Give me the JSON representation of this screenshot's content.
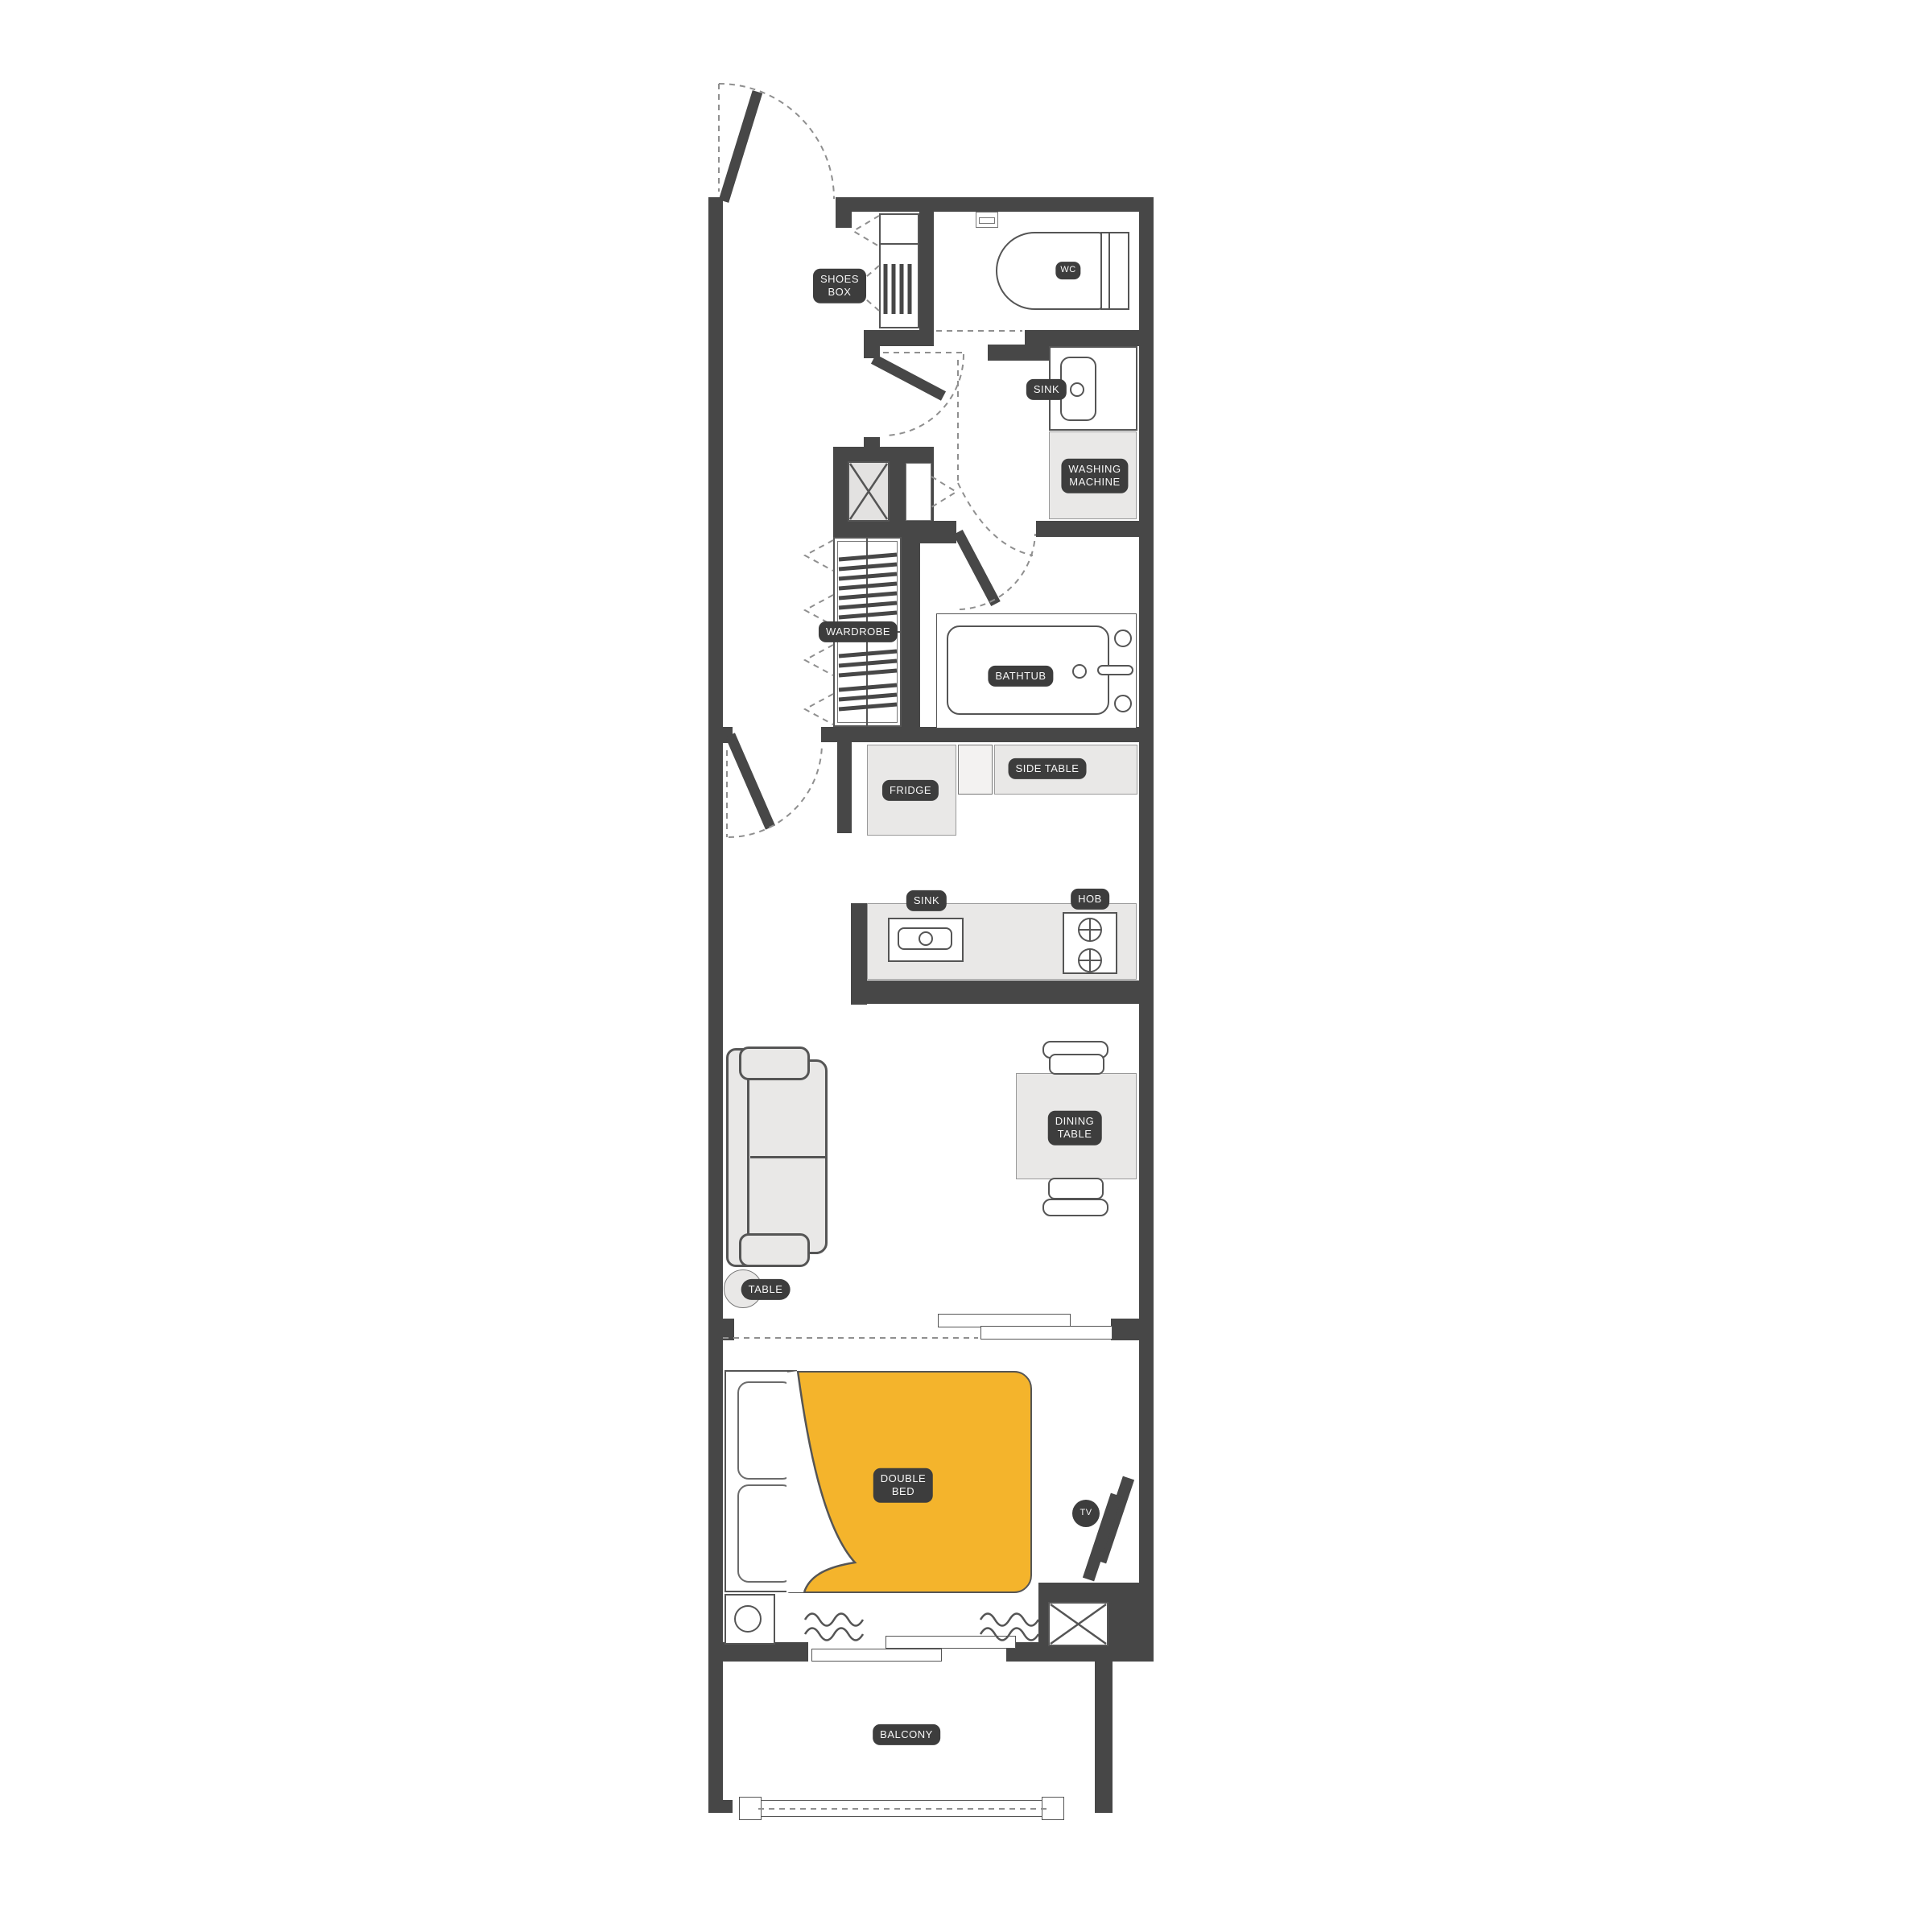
{
  "colors": {
    "wall": "#474747",
    "furniture": "#e9e8e7",
    "bed_accent": "#f4b42c",
    "label_bg": "#3d3d3d",
    "label_text": "#f7f7f7"
  },
  "labels": {
    "shoes_box": [
      "SHOES",
      "BOX"
    ],
    "wc": "WC",
    "bath_sink": "SINK",
    "washing_machine": [
      "WASHING",
      "MACHINE"
    ],
    "wardrobe": "WARDROBE",
    "bathtub": "BATHTUB",
    "fridge": "FRIDGE",
    "side_table": "SIDE TABLE",
    "kitchen_sink": "SINK",
    "hob": "HOB",
    "dining_table": [
      "DINING",
      "TABLE"
    ],
    "coffee_table": "TABLE",
    "double_bed": [
      "DOUBLE",
      "BED"
    ],
    "tv": "TV",
    "balcony": "BALCONY"
  }
}
